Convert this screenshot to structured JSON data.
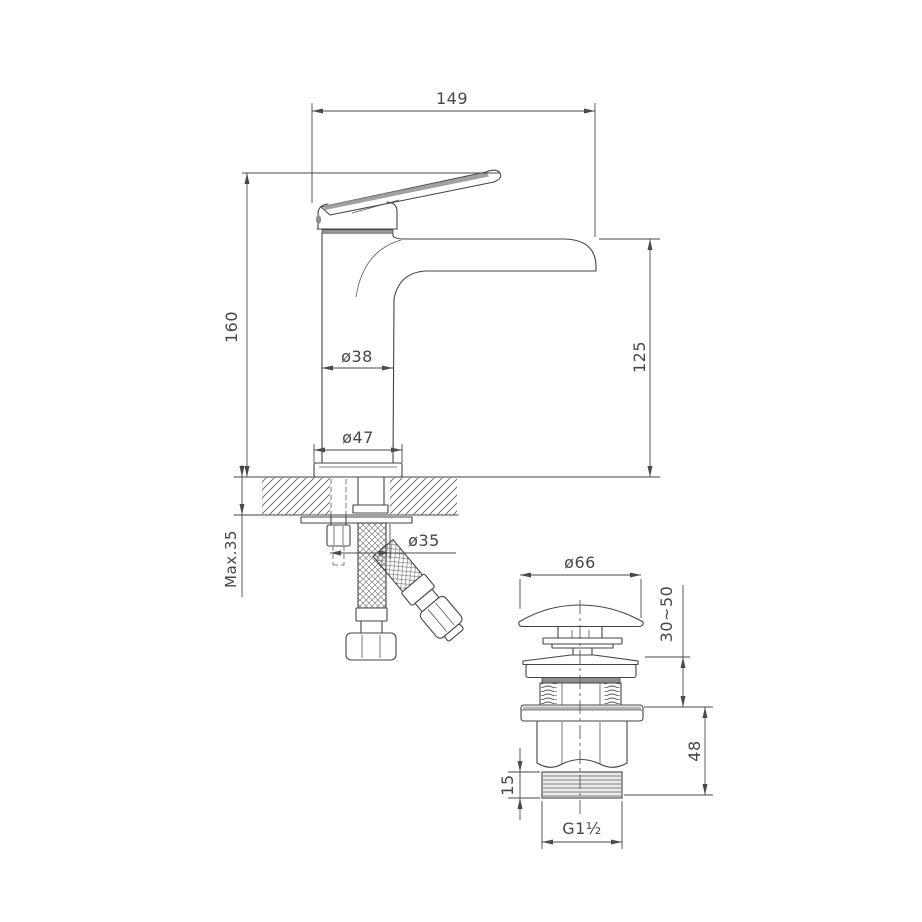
{
  "colors": {
    "background": "#ffffff",
    "line": "#454545",
    "dim_text": "#474747",
    "shading": "#909090"
  },
  "faucet": {
    "dimensions": {
      "spout_reach": "149",
      "height": "160",
      "spout_height": "125",
      "body_diameter": "ø38",
      "base_diameter": "ø47",
      "max_deck_thickness": "Max.35",
      "hole_diameter": "ø35"
    }
  },
  "drain": {
    "dimensions": {
      "cap_diameter": "ø66",
      "mount_range": "30~50",
      "body_height": "48",
      "thread_length": "15",
      "thread_spec": "G1½"
    }
  }
}
